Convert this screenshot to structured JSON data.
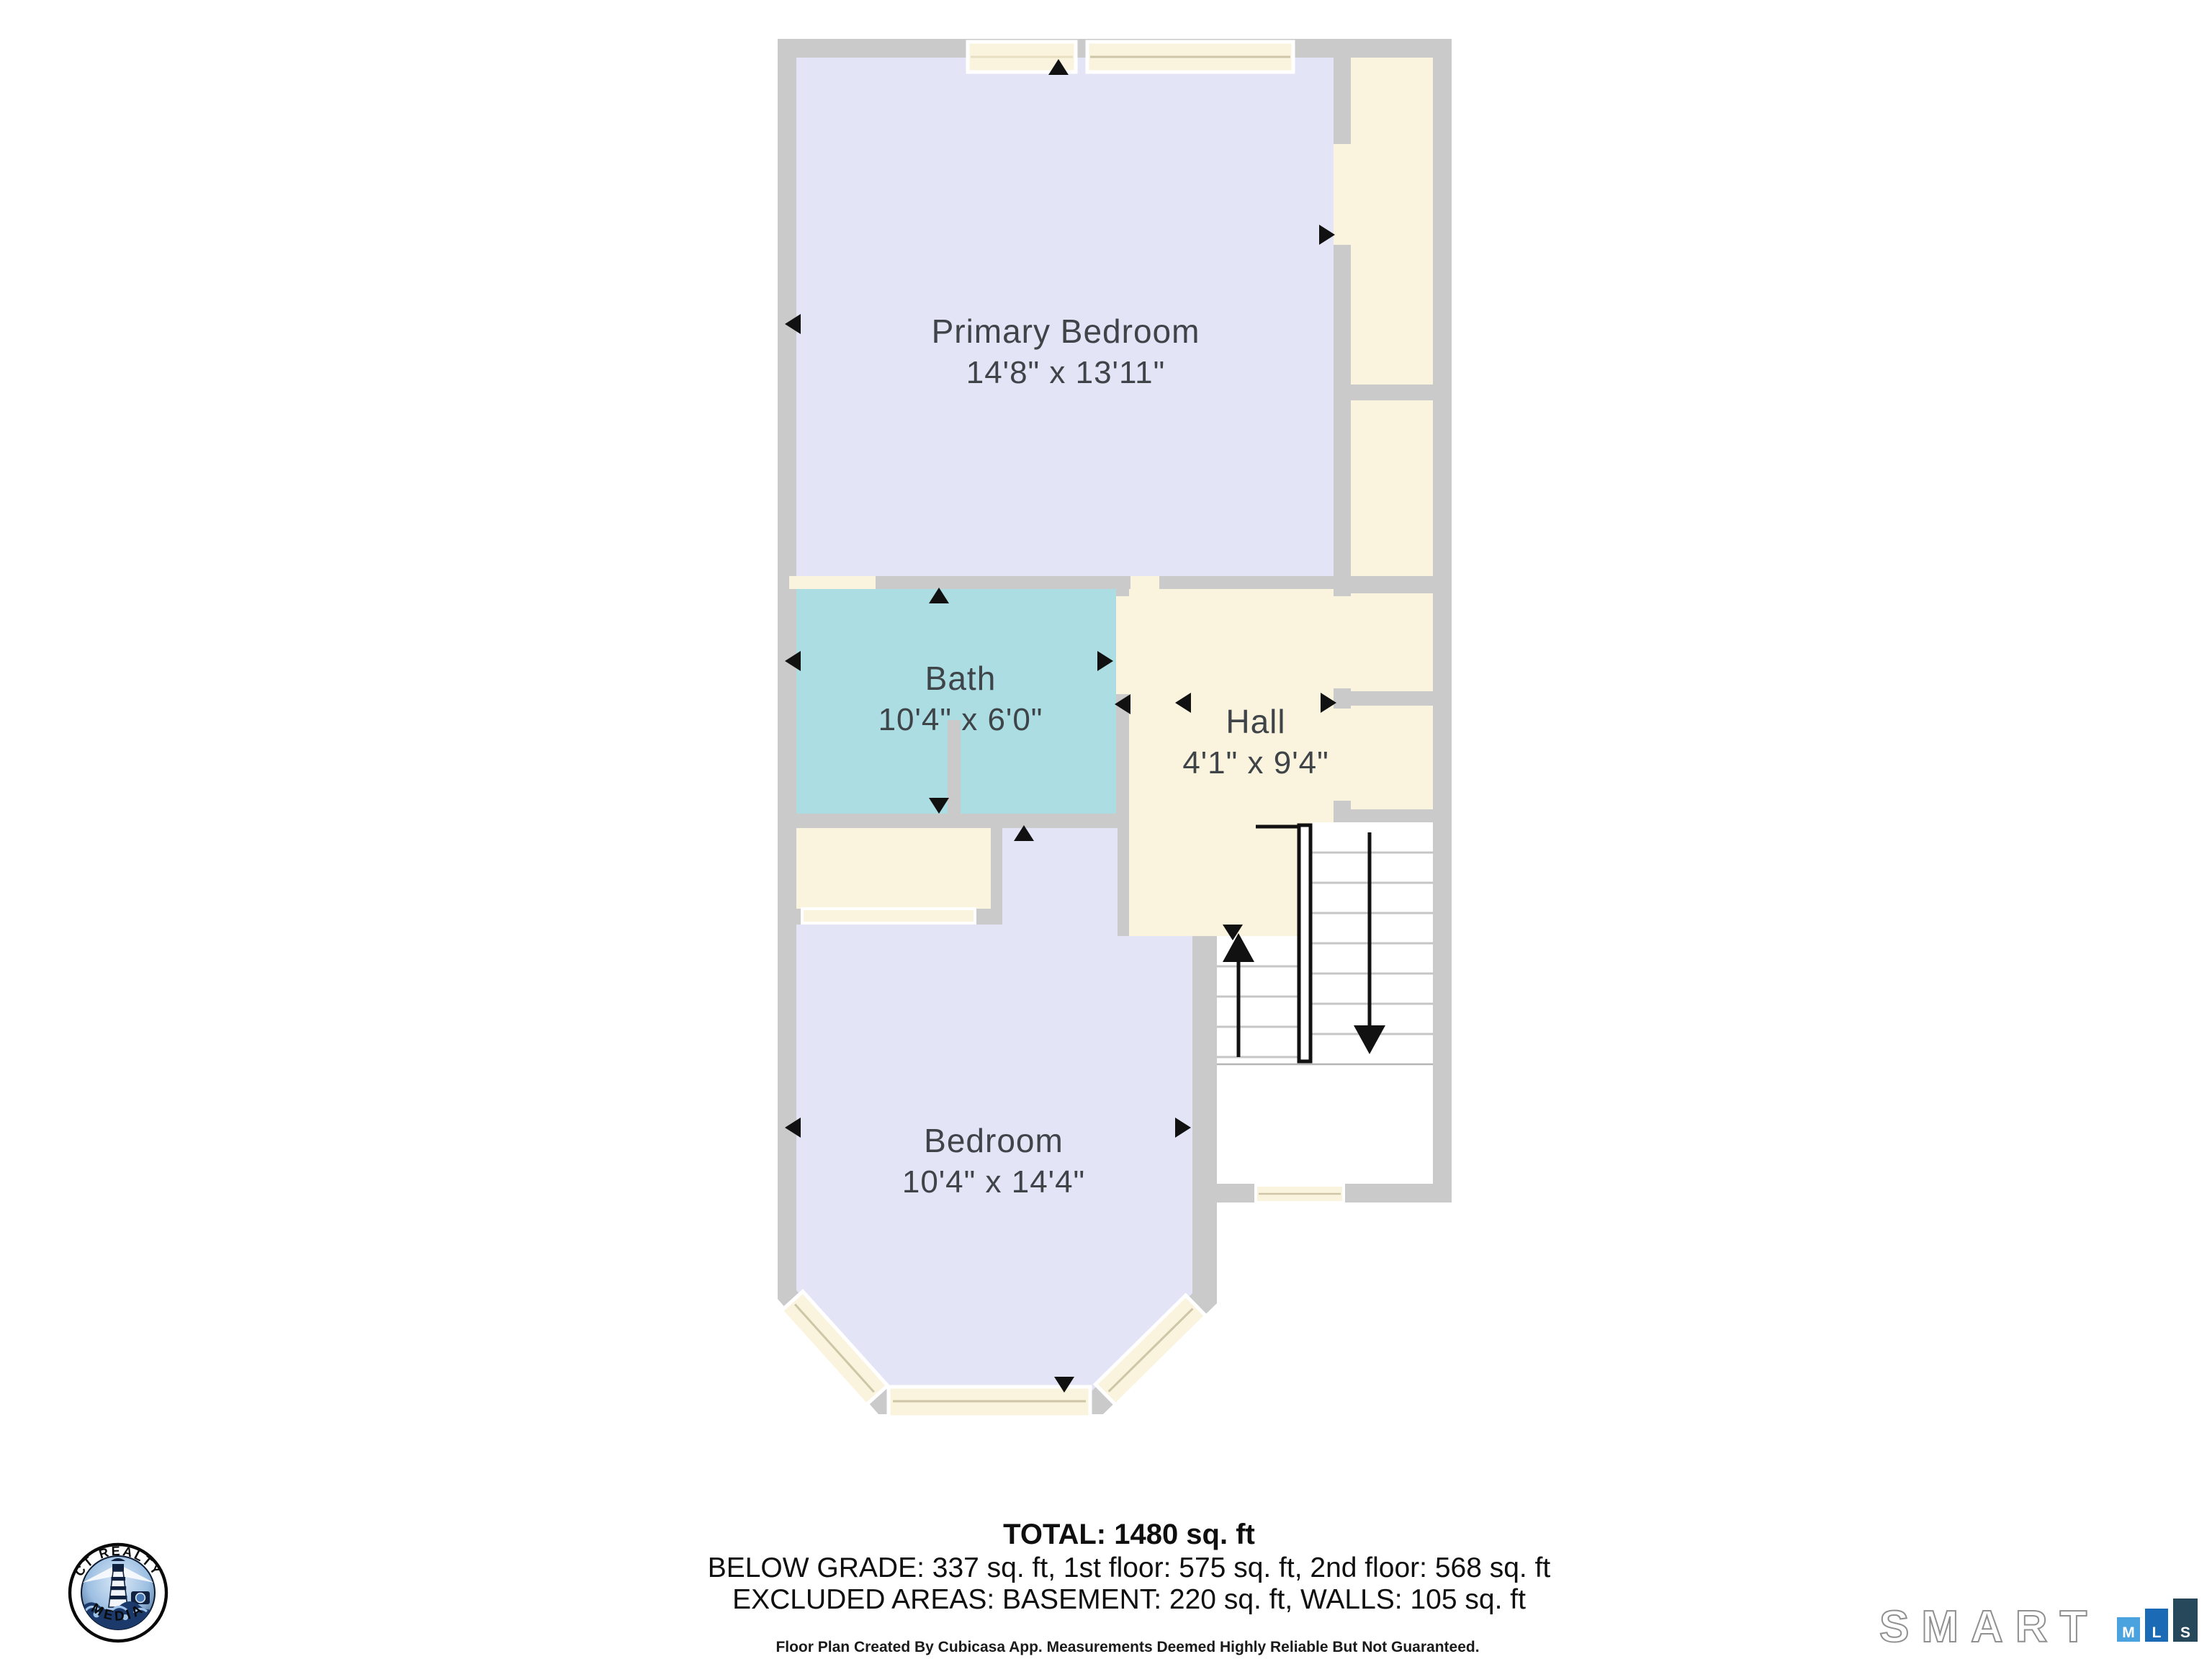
{
  "plan": {
    "rooms": [
      {
        "id": "primary-bedroom",
        "name": "Primary Bedroom",
        "dims": "14'8\" x 13'11\""
      },
      {
        "id": "bath",
        "name": "Bath",
        "dims": "10'4\" x 6'0\""
      },
      {
        "id": "hall",
        "name": "Hall",
        "dims": "4'1\" x 9'4\""
      },
      {
        "id": "bedroom",
        "name": "Bedroom",
        "dims": "10'4\" x 14'4\""
      }
    ],
    "colors": {
      "wall": "#cacaca",
      "bedroom_fill": "#e3e4f6",
      "bath_fill": "#abdde2",
      "hall_fill": "#faf3dd",
      "closet_fill": "#faf3dd",
      "window_fill": "#faf3dd",
      "stairs_fill": "#ffffff",
      "label_text": "#3e4448"
    }
  },
  "summary": {
    "total": "TOTAL: 1480 sq. ft",
    "below_grade": "BELOW GRADE: 337 sq. ft, 1st floor: 575 sq. ft, 2nd floor: 568 sq. ft",
    "excluded": "EXCLUDED AREAS: BASEMENT: 220 sq. ft, WALLS: 105 sq. ft",
    "disclaimer": "Floor Plan Created By Cubicasa App. Measurements Deemed Highly Reliable But Not Guaranteed."
  },
  "footer_logos": {
    "ct_realty": {
      "arc_top": "CT REALTY",
      "arc_bottom": "MEDIA"
    },
    "smart_mls": {
      "word": "SMART",
      "squares": [
        {
          "letter": "M",
          "color": "#4aa2de"
        },
        {
          "letter": "L",
          "color": "#1a6ab5"
        },
        {
          "letter": "S",
          "color": "#27475a"
        }
      ]
    }
  }
}
